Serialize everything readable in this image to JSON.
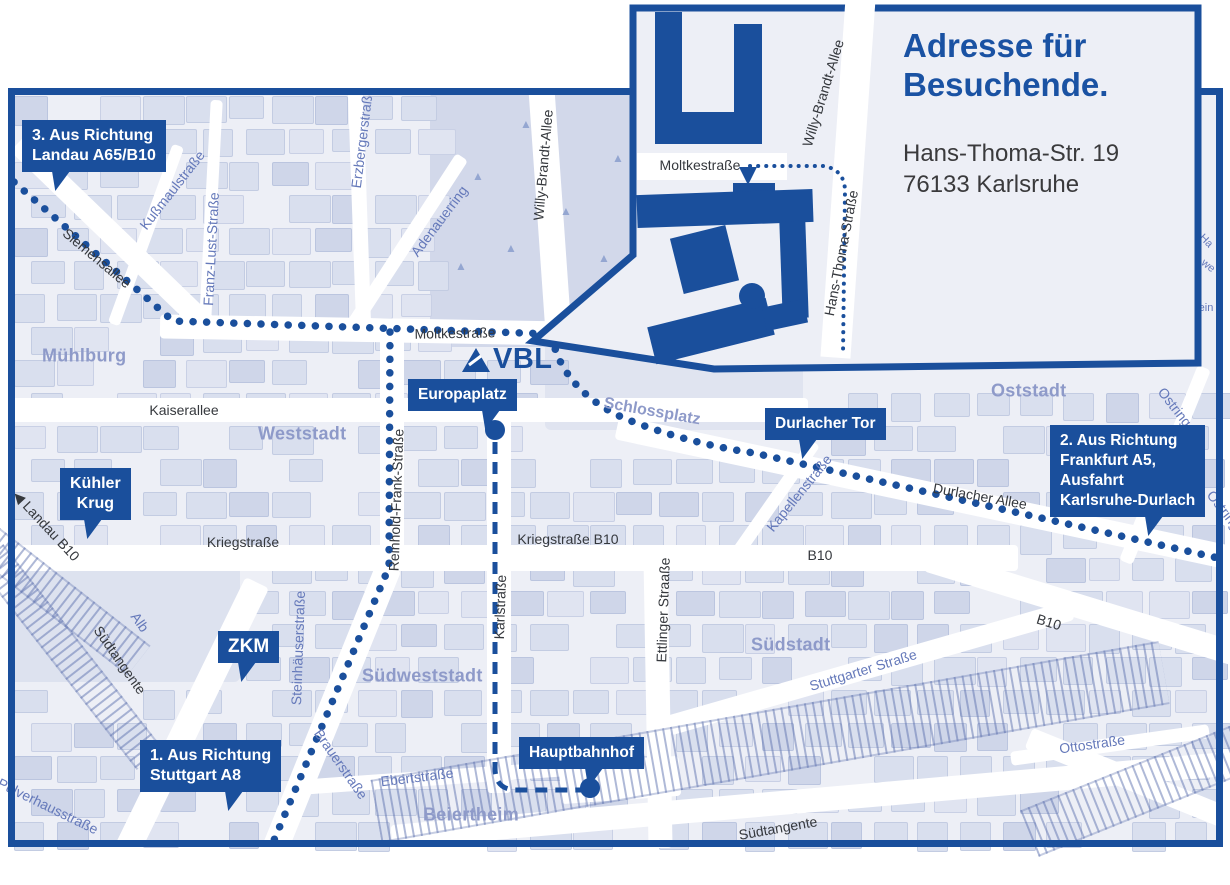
{
  "colors": {
    "primary": "#1a4f9c",
    "map_bg": "#edeff6",
    "block": "#d9dfee",
    "block_dark": "#cfd6e9",
    "block_light": "#e0e4f1",
    "park": "#d2d8ea",
    "park_light": "#e0e4f0",
    "road": "#ffffff",
    "district_label": "#8e9ac9",
    "street_label_dark": "#35383d",
    "street_label_blue": "#6579ba",
    "heading_blue": "#1a52a3",
    "address_text": "#3a3a3c"
  },
  "logo": {
    "text": "VBL",
    "triangle_icon": "vbl-triangle"
  },
  "inset": {
    "title_lines": [
      "Adresse für",
      "Besuchende."
    ],
    "address_lines": [
      "Hans-Thoma-Str. 19",
      "76133 Karlsruhe"
    ],
    "street_labels": [
      {
        "text": "Moltkestraße",
        "x": 700,
        "y": 165,
        "rot": 0
      },
      {
        "text": "Willy-Brandt-Allee",
        "x": 823,
        "y": 93,
        "rot": -73
      },
      {
        "text": "Hans-Thoma-Straße",
        "x": 841,
        "y": 253,
        "rot": -79
      }
    ],
    "route_arrow_icon": "down-arrow-icon"
  },
  "callouts": [
    {
      "name": "callout-direction-3",
      "lines": [
        "3. Aus Richtung",
        "Landau A65/B10"
      ],
      "x": 22,
      "y": 120,
      "tail_left": 30,
      "align": "left",
      "fs": 16
    },
    {
      "name": "callout-kuehler-krug",
      "lines": [
        "Kühler",
        "Krug"
      ],
      "x": 60,
      "y": 468,
      "tail_left": 24,
      "align": "center",
      "fs": 16
    },
    {
      "name": "callout-zkm",
      "lines": [
        "ZKM"
      ],
      "x": 218,
      "y": 631,
      "tail_left": 20,
      "align": "center",
      "fs": 19
    },
    {
      "name": "callout-direction-1",
      "lines": [
        "1. Aus Richtung",
        "Stuttgart A8"
      ],
      "x": 140,
      "y": 740,
      "tail_left": 85,
      "align": "left",
      "fs": 16
    },
    {
      "name": "callout-europaplatz",
      "lines": [
        "Europaplatz"
      ],
      "x": 408,
      "y": 379,
      "tail_left": 74,
      "align": "center",
      "fs": 15.5
    },
    {
      "name": "callout-durlacher-tor",
      "lines": [
        "Durlacher Tor"
      ],
      "x": 765,
      "y": 408,
      "tail_left": 34,
      "align": "center",
      "fs": 15.5
    },
    {
      "name": "callout-hauptbahnhof",
      "lines": [
        "Hauptbahnhof"
      ],
      "x": 519,
      "y": 737,
      "tail_left": 66,
      "align": "center",
      "fs": 15.5
    },
    {
      "name": "callout-direction-2",
      "lines": [
        "2. Aus Richtung",
        "Frankfurt A5,",
        "Ausfahrt",
        "Karlsruhe-Durlach"
      ],
      "x": 1050,
      "y": 425,
      "tail_left": 95,
      "align": "left",
      "fs": 15.5
    }
  ],
  "markers": [
    {
      "name": "stop-europaplatz",
      "x": 495,
      "y": 430
    },
    {
      "name": "stop-hauptbahnhof",
      "x": 590,
      "y": 788
    }
  ],
  "districts": [
    {
      "text": "Mühlburg",
      "x": 42,
      "y": 356
    },
    {
      "text": "Weststadt",
      "x": 258,
      "y": 434
    },
    {
      "text": "Südweststadt",
      "x": 362,
      "y": 676
    },
    {
      "text": "Südstadt",
      "x": 751,
      "y": 645
    },
    {
      "text": "Oststadt",
      "x": 991,
      "y": 391
    },
    {
      "text": "Beiertheim",
      "x": 423,
      "y": 815
    }
  ],
  "street_labels": [
    {
      "text": "Siemensallee",
      "x": 97,
      "y": 258,
      "rot": 40,
      "c": "d"
    },
    {
      "text": "Kußmaulstraße",
      "x": 172,
      "y": 190,
      "rot": -52,
      "c": "b"
    },
    {
      "text": "Franz-Lust-Straße",
      "x": 211,
      "y": 249,
      "rot": -87,
      "c": "b"
    },
    {
      "text": "Erzbergerstraße",
      "x": 362,
      "y": 138,
      "rot": -83,
      "c": "b"
    },
    {
      "text": "Adenauerring",
      "x": 439,
      "y": 221,
      "rot": -53,
      "c": "b"
    },
    {
      "text": "Willy-Brandt-Allee",
      "x": 543,
      "y": 165,
      "rot": -85,
      "c": "d"
    },
    {
      "text": "Moltkestraße",
      "x": 455,
      "y": 333,
      "rot": -1,
      "c": "d"
    },
    {
      "text": "Kaiserallee",
      "x": 184,
      "y": 410,
      "rot": 0,
      "c": "d"
    },
    {
      "text": "Schlossplatz",
      "x": 652,
      "y": 412,
      "rot": 10,
      "c": "g"
    },
    {
      "text": "Reinhold-Frank-Straße",
      "x": 396,
      "y": 500,
      "rot": -88,
      "c": "d"
    },
    {
      "text": "Kriegstraße",
      "x": 243,
      "y": 542,
      "rot": 0,
      "c": "d"
    },
    {
      "text": "Kriegstraße B10",
      "x": 568,
      "y": 539,
      "rot": 0,
      "c": "d"
    },
    {
      "text": "Karlstraße",
      "x": 500,
      "y": 607,
      "rot": -88,
      "c": "d"
    },
    {
      "text": "Ettlinger Straaße",
      "x": 663,
      "y": 610,
      "rot": -88,
      "c": "d"
    },
    {
      "text": "Kapellenstraße",
      "x": 799,
      "y": 493,
      "rot": -51,
      "c": "b"
    },
    {
      "text": "Durlacher Allee",
      "x": 980,
      "y": 496,
      "rot": 10,
      "c": "d"
    },
    {
      "text": "B10",
      "x": 820,
      "y": 555,
      "rot": 0,
      "c": "d"
    },
    {
      "text": "B10",
      "x": 1049,
      "y": 622,
      "rot": 17,
      "c": "d"
    },
    {
      "text": "Ostring",
      "x": 1175,
      "y": 407,
      "rot": 52,
      "c": "b"
    },
    {
      "text": "Ostring",
      "x": 1224,
      "y": 510,
      "rot": 52,
      "c": "b"
    },
    {
      "text": "Stuttgarter Straße",
      "x": 863,
      "y": 670,
      "rot": -17,
      "c": "b"
    },
    {
      "text": "Steinhäuserstraße",
      "x": 298,
      "y": 648,
      "rot": -88,
      "c": "b"
    },
    {
      "text": "Südtangente",
      "x": 120,
      "y": 660,
      "rot": 55,
      "c": "d"
    },
    {
      "text": "Südtangente",
      "x": 778,
      "y": 828,
      "rot": -10,
      "c": "d"
    },
    {
      "text": "Alb",
      "x": 140,
      "y": 622,
      "rot": 55,
      "c": "b"
    },
    {
      "text": "Brauerstraße",
      "x": 341,
      "y": 764,
      "rot": 55,
      "c": "b"
    },
    {
      "text": "Ebertstraße",
      "x": 417,
      "y": 777,
      "rot": -7,
      "c": "b"
    },
    {
      "text": "Ottostraße",
      "x": 1092,
      "y": 744,
      "rot": -8,
      "c": "b"
    },
    {
      "text": "Pulverhausstraße",
      "x": 48,
      "y": 806,
      "rot": 26,
      "c": "b"
    },
    {
      "text": "◀ Landau B10",
      "x": 46,
      "y": 526,
      "rot": 47,
      "c": "d"
    }
  ],
  "edge_fragments": [
    {
      "text": "Ha",
      "x": 1206,
      "y": 241,
      "rot": 45
    },
    {
      "text": "we",
      "x": 1208,
      "y": 266,
      "rot": 38
    },
    {
      "text": "ein",
      "x": 1206,
      "y": 308,
      "rot": 0
    }
  ],
  "routes": {
    "dotted": [
      "M 14 182 L 173 321 L 552 334",
      "M 390 332 L 389 567 L 272 845",
      "M 552 336 C 558 372 586 402 626 419 C 666 435 712 447 754 453 L 1218 558"
    ],
    "dashed": [
      "M 495 442 L 495 768 Q 495 789 515 790 L 584 790"
    ],
    "inset_dotted": "M 750 166 L 823 166 Q 844 169 845 190 L 843 354"
  }
}
